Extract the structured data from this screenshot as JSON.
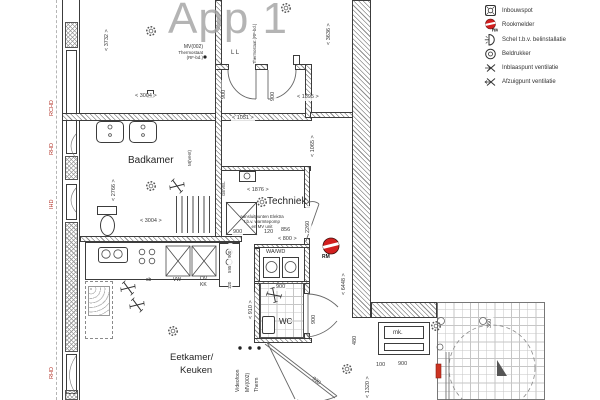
{
  "title": "App 1",
  "legend": {
    "items": [
      {
        "label": "Inbouwspot"
      },
      {
        "label": "Rookmelder"
      },
      {
        "label": "Schel t.b.v. belinstallatie"
      },
      {
        "label": "Beldrukker"
      },
      {
        "label": "Inblaaspunt ventilatie"
      },
      {
        "label": "Afzuigpunt ventilatie"
      }
    ]
  },
  "rooms": {
    "badkamer": "Badkamer",
    "techniek": "Techniek",
    "wc": "WC",
    "wawd": "WA/WD",
    "eetkamer_line1": "Eetkamer/",
    "eetkamer_line2": "Keuken",
    "meterkast": "mk."
  },
  "window_codes": [
    "RCHD",
    "RHD",
    "IHD",
    "RHD"
  ],
  "annotations": {
    "mv002": "MV(002)",
    "thermostaat": "Thermostaat",
    "rf_code": "(RF-bd.)",
    "ll": "L L",
    "thermostaat_vertical": "Thermostaat (RF-bd.)",
    "m_vent": "M(Vent)",
    "gevel": "GEVEL",
    "elektra_line1": "aansluitpunten Elektra",
    "elektra_line2": "t.b.v. warmtepomp",
    "elektra_line3": "en MV unit",
    "rm": "RM",
    "videofoon": "Videofoon",
    "mv002_b": "MV(002)",
    "therm": "Therm",
    "vw": "VW",
    "ov": "OV",
    "kk": "KK",
    "sb": "sb"
  },
  "dims": [
    "< 3732 >",
    "< 3004 >",
    "< 1051 >",
    "< 1895 >",
    "< 3636 >",
    "< 1065 >",
    "< 2766 >",
    "< 3004 >",
    "< 1876 >",
    "2260",
    "900",
    "120",
    "856",
    "< 800 >",
    "< 910 >",
    "900",
    "900",
    "900",
    "900",
    "< 6448 >",
    "480",
    "100",
    "900",
    "< 1320 >",
    "930",
    "360",
    "900",
    "595",
    "120"
  ],
  "colors": {
    "red_label": "#b5372c",
    "smoke_detector": "#d21f1f",
    "line": "#3c3c3c",
    "title_gray": "#a2a2a2"
  }
}
